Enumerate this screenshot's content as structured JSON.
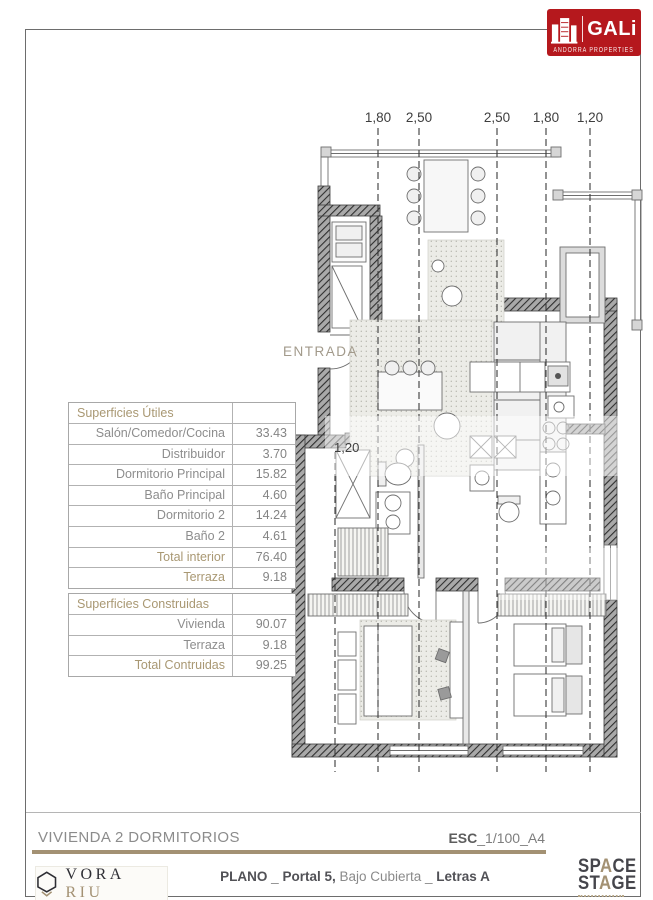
{
  "logo": {
    "brand": "GALi",
    "subtitle": "ANDORRA PROPERTIES"
  },
  "plan": {
    "entrada": "ENTRADA",
    "dims_top": [
      "1,80",
      "2,50",
      "2,50",
      "1,80",
      "1,20"
    ],
    "dim_inner": "1,20"
  },
  "tables": [
    {
      "title": "Superficies Útiles",
      "rows": [
        {
          "label": "Salón/Comedor/Cocina",
          "value": "33.43",
          "accent": false
        },
        {
          "label": "Distribuidor",
          "value": "3.70",
          "accent": false
        },
        {
          "label": "Dormitorio Principal",
          "value": "15.82",
          "accent": false
        },
        {
          "label": "Baño Principal",
          "value": "4.60",
          "accent": false
        },
        {
          "label": "Dormitorio 2",
          "value": "14.24",
          "accent": false
        },
        {
          "label": "Baño 2",
          "value": "4.61",
          "accent": false
        },
        {
          "label": "Total interior",
          "value": "76.40",
          "accent": true
        },
        {
          "label": "Terraza",
          "value": "9.18",
          "accent": true
        }
      ]
    },
    {
      "title": "Superficies Construidas",
      "rows": [
        {
          "label": "Vivienda",
          "value": "90.07",
          "accent": false
        },
        {
          "label": "Terraza",
          "value": "9.18",
          "accent": false
        },
        {
          "label": "Total Contruidas",
          "value": "99.25",
          "accent": true
        }
      ]
    }
  ],
  "footer": {
    "title": "VIVIENDA 2 DORMITORIOS",
    "scale_bold": "ESC",
    "scale_rest": "_1/100_A4",
    "plano": {
      "p1": "PLANO",
      "sep1": " _ ",
      "p2": "Portal 5,",
      "p3": " Bajo Cubierta ",
      "sep2": "_ ",
      "p4": "Letras A"
    },
    "vora": {
      "word1": "VORA",
      "word2": "RIU"
    },
    "space_stage": {
      "l1a": "SP",
      "l1b": "A",
      "l1c": "CE",
      "l2a": "ST",
      "l2b": "A",
      "l2c": "GE"
    }
  }
}
